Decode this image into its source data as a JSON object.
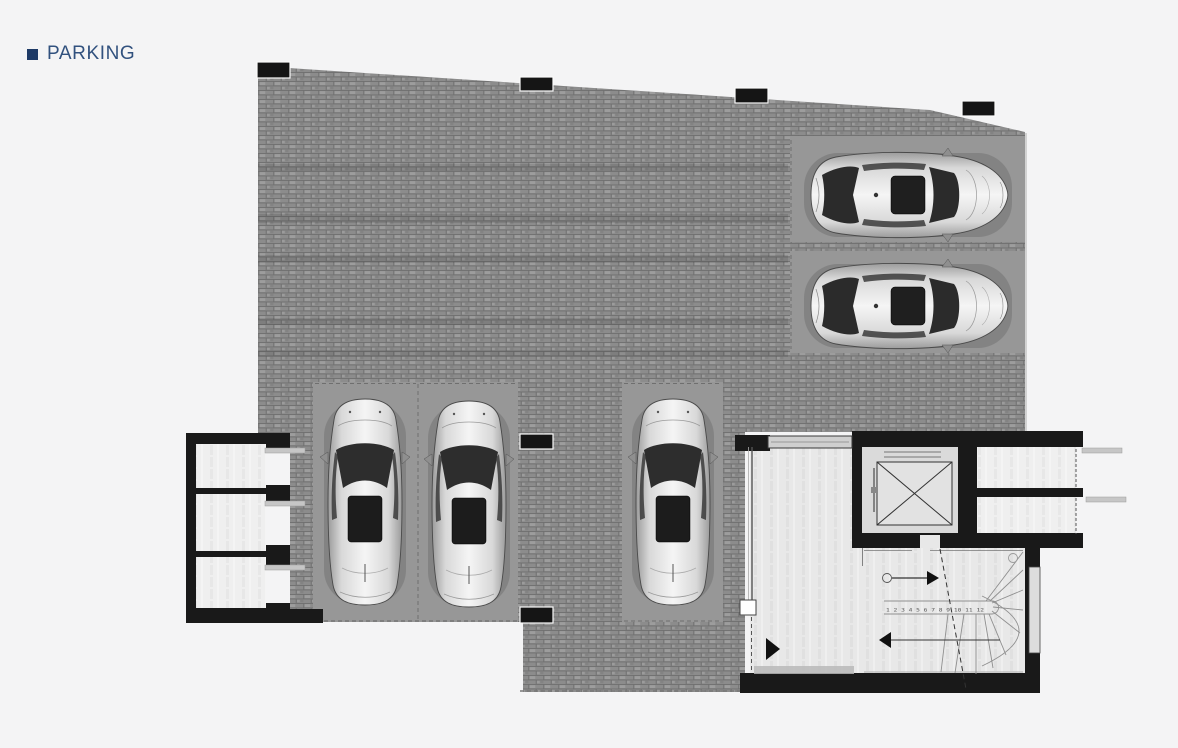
{
  "header": {
    "bullet_icon": "square-bullet-icon",
    "title": "PARKING"
  },
  "colors": {
    "accent_navy": "#31517e",
    "bullet_navy": "#1e3a66",
    "page_bg": "#f4f4f5",
    "paving_base": "#8c8c8c",
    "paving_joint": "#6f6f6f",
    "pad_gray": "#979797",
    "wall_black": "#191919",
    "room_floor": "#efefef",
    "lobby_floor": "#e8e8e8",
    "elevator_floor": "#dadada",
    "stair_stroke": "#8f8f8f"
  },
  "plan": {
    "type": "floor-plan",
    "parking_spaces": [
      {
        "id": "space-1",
        "orientation": "horizontal",
        "vehicle": "sedan-top-view"
      },
      {
        "id": "space-2",
        "orientation": "horizontal",
        "vehicle": "sedan-top-view"
      },
      {
        "id": "space-3",
        "orientation": "vertical",
        "vehicle": "car-top-view"
      },
      {
        "id": "space-4",
        "orientation": "vertical",
        "vehicle": "car-top-view"
      },
      {
        "id": "space-5",
        "orientation": "vertical",
        "vehicle": "car-top-view"
      }
    ],
    "storage_rooms_left_count": 3,
    "storage_rooms_right_count": 2,
    "staircase": {
      "step_numbers": "1 2 3 4 5 6 7 8 9 10 11 12"
    },
    "elevator_symbol": "crossed-box-icon",
    "pillar_count": 7
  }
}
